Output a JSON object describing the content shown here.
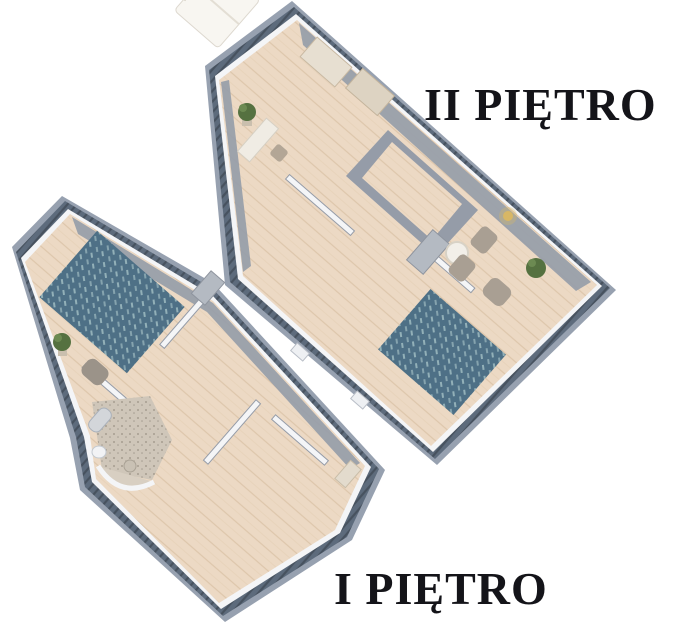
{
  "page": {
    "width": 673,
    "height": 628,
    "background": "#ffffff"
  },
  "labels": {
    "floor2": "II PIĘTRO",
    "floor1": "I PIĘTRO"
  },
  "palette": {
    "page_bg": "#ffffff",
    "text_black": "#141419",
    "floor_wood": "#ecd9c4",
    "floor_wood_line": "#ddc6ab",
    "wall_outer": "#97a1b0",
    "band_dark": "#5d6b7c",
    "band_stripe": "#47525f",
    "wall_white": "#f4f5f7",
    "wall_gray": "#959ca8",
    "wall_gray_dark": "#6e7684",
    "rug_base": "#4e7086",
    "rug_stripe": "#92b0b8",
    "bedding": "#f8f6f1",
    "furniture_beige": "#b3a696",
    "furniture_light": "#e7dfd1",
    "cabinet_gray": "#b4bac2",
    "cabinet_dark": "#4a5058",
    "plant_green": "#557140",
    "stair_wood": "#d9c2a5",
    "bath_floor": "#cfc6b9",
    "bath_speck": "#9a9184",
    "lamp_gold": "#d8b765"
  }
}
